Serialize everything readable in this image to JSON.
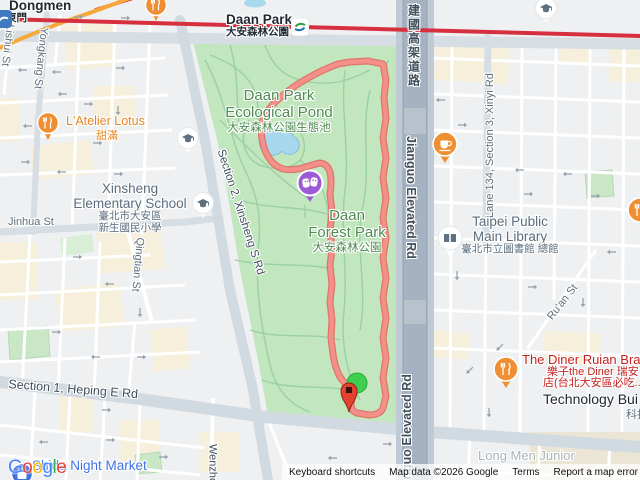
{
  "stations": {
    "dongmen": {
      "en": "Dongmen",
      "zh": "東門"
    },
    "daan_park": {
      "en": "Daan Park",
      "zh": "大安森林公園"
    }
  },
  "streets": {
    "lishui": "Lishui St",
    "yongkang": "Yongkang St",
    "jinhua": "Jinhua St",
    "qingtian": "Qingtian St",
    "xinsheng": "Section 2, Xinsheng S Rd",
    "heping": "Section 1, Heping E Rd",
    "wenzhou": "Wenzhou St",
    "jianguo_zh": "建國高架道路",
    "jianguo_en": "Jianguo Elevated Rd",
    "jianguo_en_lower": "Jianguo Elevated Rd",
    "xinyi": "Lane 134, Section 3, Xinyi Rd",
    "ruan": "Ru'an St"
  },
  "park": {
    "pond_line1": "Daan Park",
    "pond_line2": "Ecological Pond",
    "pond_zh": "大安森林公園生態池",
    "forest_line1": "Daan",
    "forest_line2": "Forest Park",
    "forest_zh": "大安森林公園"
  },
  "pois": {
    "latelier_en": "L'Atelier Lotus",
    "latelier_zh": "甜滿",
    "school_line1": "Xinsheng",
    "school_line2": "Elementary School",
    "school_zh1": "臺北市大安區",
    "school_zh2": "新生國民小學",
    "library_line1": "Taipei Public",
    "library_line2": "Main Library",
    "library_zh": "臺北市立圖書館 總館",
    "diner_en": "The Diner Ruian Bra",
    "diner_zh1": "樂子the Diner 瑞安",
    "diner_zh2": "店(台北大安區必吃...",
    "tech": "Technology Bui",
    "tech_zh": "科技",
    "longmen": "Long Men Junior",
    "shida": "Shida Night Market"
  },
  "watermark": {
    "letters": [
      "G",
      "o",
      "o",
      "g",
      "l",
      "e"
    ]
  },
  "attribution": {
    "keyboard": "Keyboard shortcuts",
    "map_data": "Map data ©2026 Google",
    "terms": "Terms",
    "report": "Report a map error"
  },
  "colors": {
    "route": "#f0837a",
    "park_green": "#c2e6bd",
    "water_blue": "#a8d8ee",
    "metro_red": "#d63040",
    "metro_orange": "#f5a93c",
    "poi_orange": "#ef8f33",
    "poi_purple": "#9d5ad4",
    "poi_blue": "#4273db",
    "poi_red_text": "#c5221f",
    "park_label_green": "#4c8a50",
    "street_label": "#5e6e7e"
  }
}
